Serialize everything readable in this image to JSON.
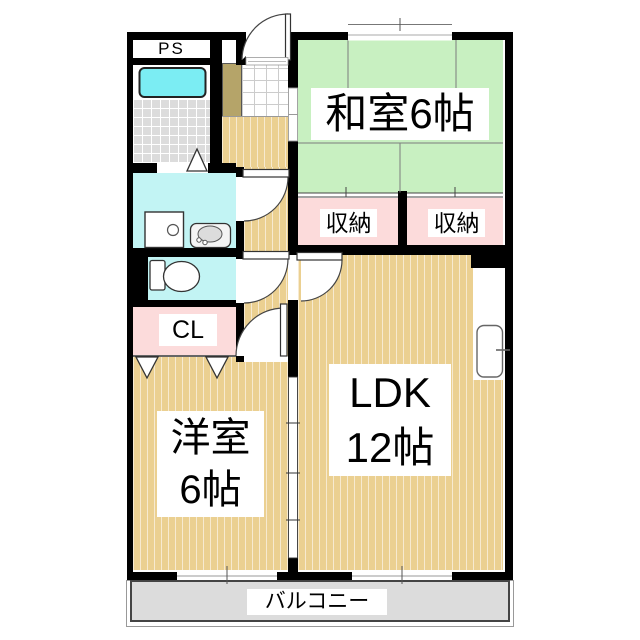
{
  "plan_title": "apartment-floor-plan",
  "rooms": {
    "ps": {
      "label": "PS"
    },
    "washitsu": {
      "label": "和室6帖"
    },
    "storage_left": {
      "label": "収納"
    },
    "storage_right": {
      "label": "収納"
    },
    "closet": {
      "label": "CL"
    },
    "youshitsu": {
      "line1": "洋室",
      "line2": "6帖"
    },
    "ldk": {
      "line1": "LDK",
      "line2": "12帖"
    },
    "balcony": {
      "label": "バルコニー"
    }
  },
  "colors": {
    "wall": "#000000",
    "tatami_green": "#c8f0c1",
    "flooring_tan": "#ebd091",
    "storage_pink": "#fcdbdb",
    "wet_area_cyan": "#c2f4f4",
    "bathtub_cyan": "#7bedf3",
    "bath_tile_gray": "#dcdcdc",
    "balcony_gray": "#dcdcdc",
    "shoe_cabinet_olive": "#b5a469",
    "label_background": "#ffffff"
  },
  "fixtures": {
    "bathtub": "bathtub-icon",
    "washing_machine": "washing-machine-icon",
    "vanity_sink": "vanity-sink-icon",
    "toilet": "toilet-icon",
    "kitchen_sink": "kitchen-sink-icon",
    "entrance_door": "swing-door-icon",
    "interior_doors": "swing-door-icon",
    "bath_door": "folding-door-icon",
    "closet_doors": "folding-door-icon",
    "sliding_partition": "sliding-door-icon",
    "windows": "window-icon"
  }
}
